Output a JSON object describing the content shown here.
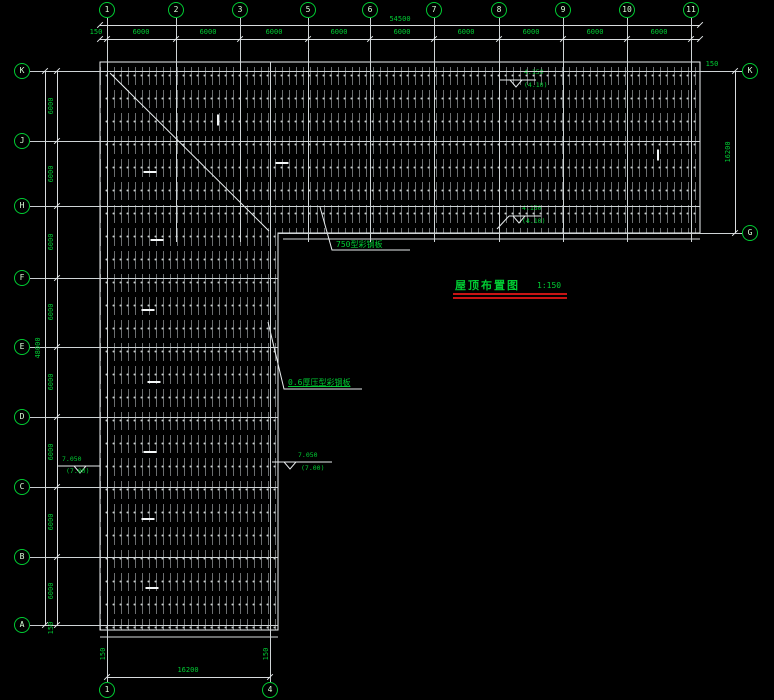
{
  "canvas": {
    "width": 774,
    "height": 700,
    "background": "#000000"
  },
  "title": {
    "text": "屋顶布置图",
    "scale": "1:150"
  },
  "colors": {
    "annotation_green": "#00cc33",
    "line_white": "#d8dcde",
    "underline_red": "#c81414"
  },
  "grid": {
    "top_columns": [
      {
        "label": "1",
        "x": 107
      },
      {
        "label": "2",
        "x": 176
      },
      {
        "label": "3",
        "x": 240
      },
      {
        "label": "5",
        "x": 308
      },
      {
        "label": "6",
        "x": 370
      },
      {
        "label": "7",
        "x": 434
      },
      {
        "label": "8",
        "x": 499
      },
      {
        "label": "9",
        "x": 563
      },
      {
        "label": "10",
        "x": 627
      },
      {
        "label": "11",
        "x": 691
      }
    ],
    "bottom_columns": [
      {
        "label": "1",
        "x": 107
      },
      {
        "label": "4",
        "x": 270
      }
    ],
    "left_rows": [
      {
        "label": "K",
        "y": 71
      },
      {
        "label": "J",
        "y": 141
      },
      {
        "label": "H",
        "y": 206
      },
      {
        "label": "F",
        "y": 278
      },
      {
        "label": "E",
        "y": 347
      },
      {
        "label": "D",
        "y": 417
      },
      {
        "label": "C",
        "y": 487
      },
      {
        "label": "B",
        "y": 557
      },
      {
        "label": "A",
        "y": 625
      }
    ],
    "right_rows": [
      {
        "label": "K",
        "y": 71
      },
      {
        "label": "G",
        "y": 233
      }
    ]
  },
  "dimensions": {
    "top_overall": {
      "text": "54500",
      "x": 400,
      "y": 19
    },
    "top_bays": [
      {
        "text": "6000",
        "x": 141
      },
      {
        "text": "6000",
        "x": 208
      },
      {
        "text": "6000",
        "x": 274
      },
      {
        "text": "6000",
        "x": 339
      },
      {
        "text": "6000",
        "x": 402
      },
      {
        "text": "6000",
        "x": 466
      },
      {
        "text": "6000",
        "x": 531
      },
      {
        "text": "6000",
        "x": 595
      },
      {
        "text": "6000",
        "x": 659
      }
    ],
    "left_overall": {
      "text": "48000",
      "x": 38,
      "y": 348
    },
    "left_bays": [
      {
        "text": "6000",
        "y": 106
      },
      {
        "text": "6000",
        "y": 174
      },
      {
        "text": "6000",
        "y": 242
      },
      {
        "text": "6000",
        "y": 312
      },
      {
        "text": "6000",
        "y": 382
      },
      {
        "text": "6000",
        "y": 452
      },
      {
        "text": "6000",
        "y": 522
      },
      {
        "text": "6000",
        "y": 591
      }
    ],
    "right_overall": {
      "text": "16200",
      "x": 728,
      "y": 152
    },
    "bottom_overall": {
      "text": "16200",
      "x": 188,
      "y": 670
    },
    "offsets": [
      {
        "text": "150",
        "x": 96,
        "y": 32,
        "rot": 0
      },
      {
        "text": "150",
        "x": 712,
        "y": 64,
        "rot": 0
      },
      {
        "text": "150",
        "x": 103,
        "y": 654,
        "rot": -90
      },
      {
        "text": "150",
        "x": 266,
        "y": 654,
        "rot": -90
      },
      {
        "text": "150",
        "x": 51,
        "y": 628,
        "rot": -90
      }
    ]
  },
  "annotations": [
    {
      "text": "750型彩钢板"
    },
    {
      "text": "0.6厚压型彩钢板"
    }
  ],
  "elevation_markers": [
    {
      "value": "4.150",
      "sub": "(4.10)"
    },
    {
      "value": "4.150",
      "sub": "(4.10)"
    },
    {
      "value": "7.050",
      "sub": "(7.00)"
    },
    {
      "value": "7.050",
      "sub": "(7.00)"
    }
  ],
  "lap_marks": [
    {
      "x": 150,
      "y": 172,
      "o": "h"
    },
    {
      "x": 157,
      "y": 240,
      "o": "h"
    },
    {
      "x": 148,
      "y": 310,
      "o": "h"
    },
    {
      "x": 154,
      "y": 382,
      "o": "h"
    },
    {
      "x": 150,
      "y": 452,
      "o": "h"
    },
    {
      "x": 148,
      "y": 519,
      "o": "h"
    },
    {
      "x": 152,
      "y": 588,
      "o": "h"
    },
    {
      "x": 282,
      "y": 163,
      "o": "h"
    },
    {
      "x": 218,
      "y": 120,
      "o": "v"
    },
    {
      "x": 658,
      "y": 155,
      "o": "v"
    }
  ]
}
